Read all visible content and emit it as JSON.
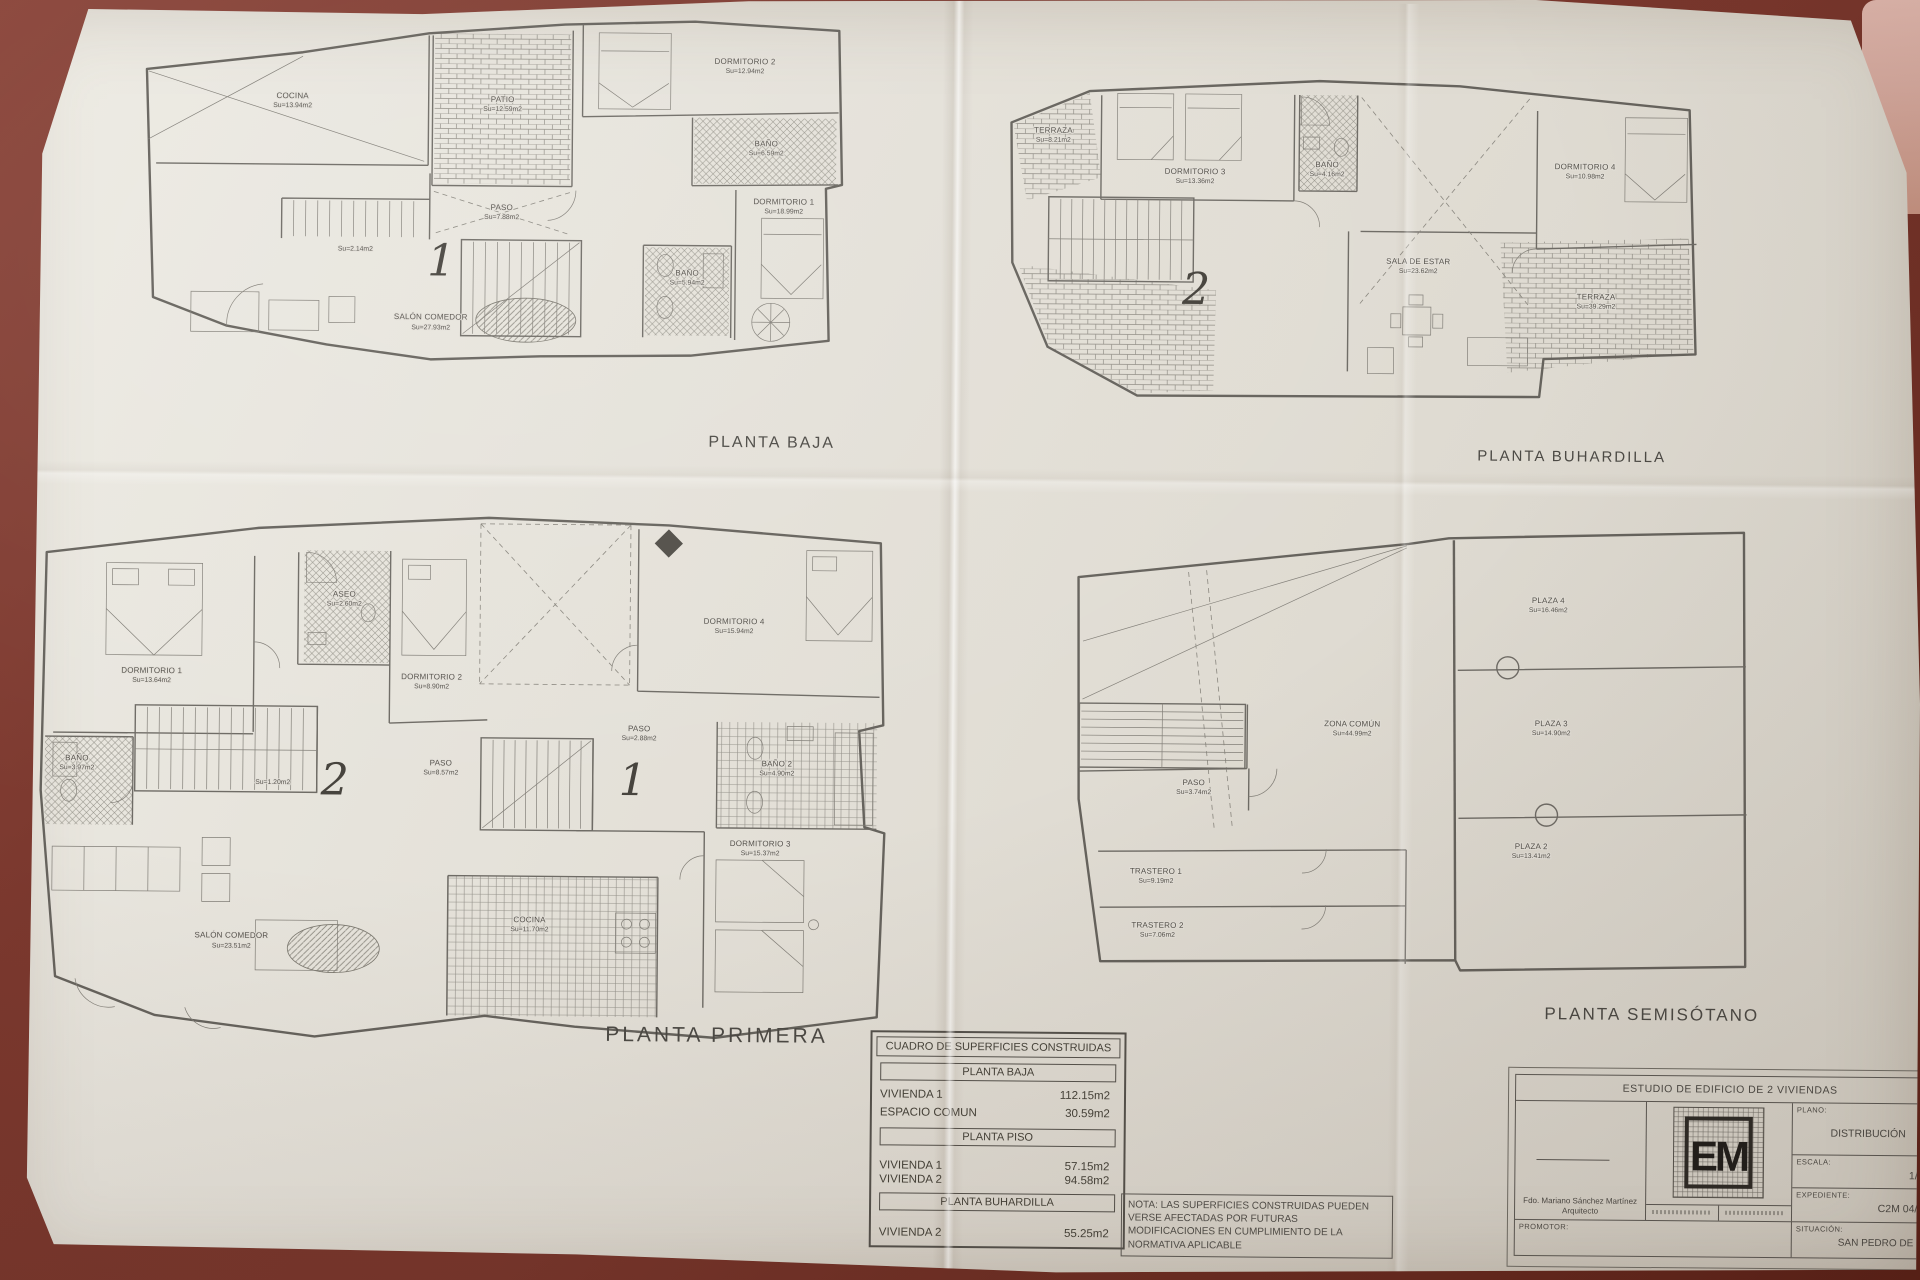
{
  "colors": {
    "table_surface": "#7b382e",
    "paper": "#e3e0d8",
    "ink": "#5a5751",
    "pink_object": "#d4a89d"
  },
  "plans": {
    "baja": {
      "title": "PLANTA BAJA",
      "unit_number": "1",
      "rooms": [
        {
          "name": "COCINA",
          "area": "Su=13.94m2"
        },
        {
          "name": "PATIO",
          "area": "Su=12.59m2"
        },
        {
          "name": "DORMITORIO 2",
          "area": "Su=12.94m2"
        },
        {
          "name": "BAÑO",
          "area": "Su=6.59m2"
        },
        {
          "name": "PASO",
          "area": "Su=7.88m2"
        },
        {
          "name": "",
          "area": "Su=2.14m2"
        },
        {
          "name": "SALÓN COMEDOR",
          "area": "Su=27.93m2"
        },
        {
          "name": "BAÑO",
          "area": "Su=5.94m2"
        },
        {
          "name": "DORMITORIO 1",
          "area": "Su=18.99m2"
        }
      ]
    },
    "buhardilla": {
      "title": "PLANTA BUHARDILLA",
      "unit_number": "2",
      "rooms": [
        {
          "name": "TERRAZA",
          "area": "Su=8.21m2"
        },
        {
          "name": "DORMITORIO 3",
          "area": "Su=13.36m2"
        },
        {
          "name": "BAÑO",
          "area": "Su=4.16m2"
        },
        {
          "name": "DORMITORIO 4",
          "area": "Su=10.98m2"
        },
        {
          "name": "SALA DE ESTAR",
          "area": "Su=23.62m2"
        },
        {
          "name": "TERRAZA",
          "area": "Su=39.29m2"
        }
      ]
    },
    "primera": {
      "title": "PLANTA PRIMERA",
      "unit_number_left": "2",
      "unit_number_right": "1",
      "rooms": [
        {
          "name": "DORMITORIO 1",
          "area": "Su=13.64m2"
        },
        {
          "name": "ASEO",
          "area": "Su=2.60m2"
        },
        {
          "name": "DORMITORIO 2",
          "area": "Su=8.90m2"
        },
        {
          "name": "DORMITORIO 4",
          "area": "Su=15.94m2"
        },
        {
          "name": "BAÑO",
          "area": "Su=3.97m2"
        },
        {
          "name": "",
          "area": "Su=1.20m2"
        },
        {
          "name": "PASO",
          "area": "Su=8.57m2"
        },
        {
          "name": "PASO",
          "area": "Su=2.88m2"
        },
        {
          "name": "BAÑO 2",
          "area": "Su=4.90m2"
        },
        {
          "name": "DORMITORIO 3",
          "area": "Su=15.37m2"
        },
        {
          "name": "SALÓN COMEDOR",
          "area": "Su=23.51m2"
        },
        {
          "name": "COCINA",
          "area": "Su=11.70m2"
        }
      ]
    },
    "semisotano": {
      "title": "PLANTA SEMISÓTANO",
      "rooms": [
        {
          "name": "PLAZA 4",
          "area": "Su=16.46m2"
        },
        {
          "name": "ZONA COMÚN",
          "area": "Su=44.99m2"
        },
        {
          "name": "PLAZA 3",
          "area": "Su=14.90m2"
        },
        {
          "name": "PASO",
          "area": "Su=3.74m2"
        },
        {
          "name": "PLAZA 2",
          "area": "Su=13.41m2"
        },
        {
          "name": "TRASTERO 1",
          "area": "Su=9.19m2"
        },
        {
          "name": "TRASTERO 2",
          "area": "Su=7.06m2"
        }
      ]
    }
  },
  "surfaces_table": {
    "title": "CUADRO DE SUPERFICIES CONSTRUIDAS",
    "sections": [
      {
        "header": "PLANTA BAJA",
        "rows": [
          {
            "label": "VIVIENDA 1",
            "value": "112.15m2"
          },
          {
            "label": "ESPACIO COMUN",
            "value": "30.59m2"
          }
        ]
      },
      {
        "header": "PLANTA PISO",
        "rows": [
          {
            "label": "VIVIENDA 1",
            "value": "57.15m2"
          },
          {
            "label": "VIVIENDA 2",
            "value": "94.58m2"
          }
        ]
      },
      {
        "header": "PLANTA BUHARDILLA",
        "rows": [
          {
            "label": "VIVIENDA 2",
            "value": "55.25m2"
          }
        ]
      }
    ]
  },
  "note": "NOTA: LAS SUPERFICIES CONSTRUIDAS PUEDEN VERSE AFECTADAS POR FUTURAS MODIFICACIONES EN CUMPLIMIENTO DE LA NORMATIVA APLICABLE",
  "title_block": {
    "project": "ESTUDIO DE EDIFICIO DE 2 VIVIENDAS",
    "plano_label": "PLANO:",
    "plano_value": "DISTRIBUCIÓN",
    "escala_label": "ESCALA:",
    "escala_value": "1/50",
    "expediente_label": "EXPEDIENTE:",
    "expediente_value": "C2M 04/01",
    "situacion_label": "SITUACIÓN:",
    "situacion_value": "SAN PEDRO DE",
    "promotor_label": "PROMOTOR:",
    "architect": "Fdo. Mariano Sánchez Martínez",
    "architect_title": "Arquitecto",
    "logo": "EM"
  }
}
